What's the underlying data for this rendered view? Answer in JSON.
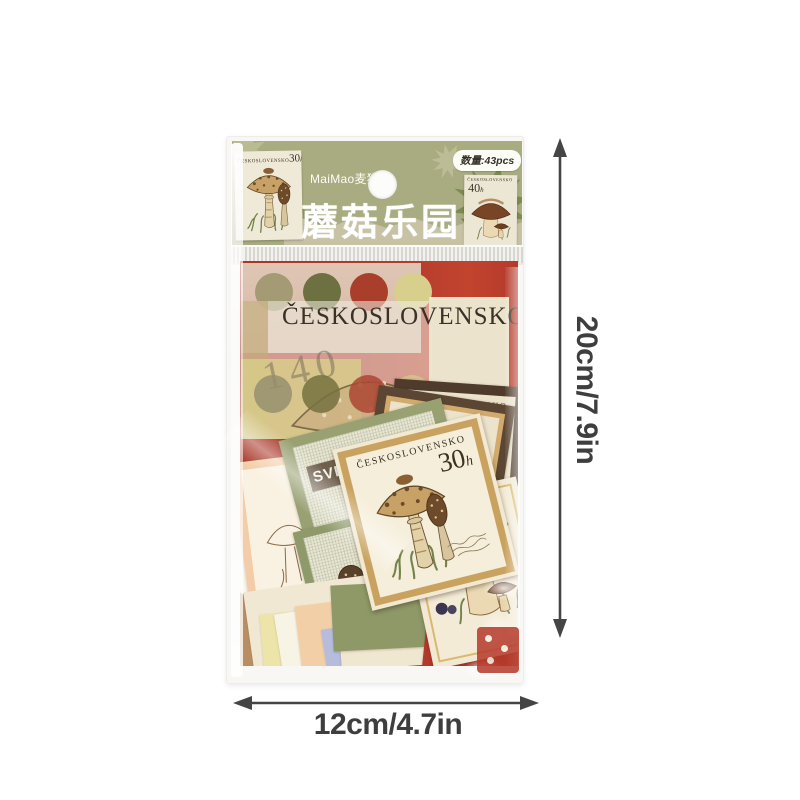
{
  "package": {
    "brand": "MaiMao麦猫®",
    "title": "蘑菇乐园",
    "quantity_badge": "数量:43pcs",
    "stamp_left": {
      "country": "ČESKOSLOVENSKO",
      "value": "30",
      "unit": "h"
    },
    "stamp_right": {
      "country": "ČESKOSLOVENSKO",
      "value": "40",
      "unit": "h"
    },
    "vellum": {
      "country": "ČESKOSLOVENSKO",
      "value": "140"
    },
    "main_stamp": {
      "country": "ČESKOSLOVENSKO",
      "value": "30",
      "unit": "h"
    },
    "sverige_stamp": {
      "country": "SVERIGE"
    },
    "brown_card_front": "ČESKO",
    "brown_card_back": "SKO",
    "peach_card_letter": "Č"
  },
  "dimensions": {
    "height": "20cm/7.9in",
    "width": "12cm/4.7in"
  },
  "colors": {
    "header_olive": "#a9ac81",
    "leaf_dark": "#7d8a52",
    "red_card": "#b23a2b",
    "accent_red": "#c0392b",
    "cream": "#f2ead6",
    "tan_frame": "#c9a25f",
    "dimension_text": "#3e3e3e",
    "dot_row1": [
      "#a49a73",
      "#6d7040",
      "#a93e2b",
      "#d9cf8c"
    ],
    "dot_row2": [
      "#958f6e",
      "#75713f",
      "#ab4632",
      "#d5cc8d"
    ]
  }
}
